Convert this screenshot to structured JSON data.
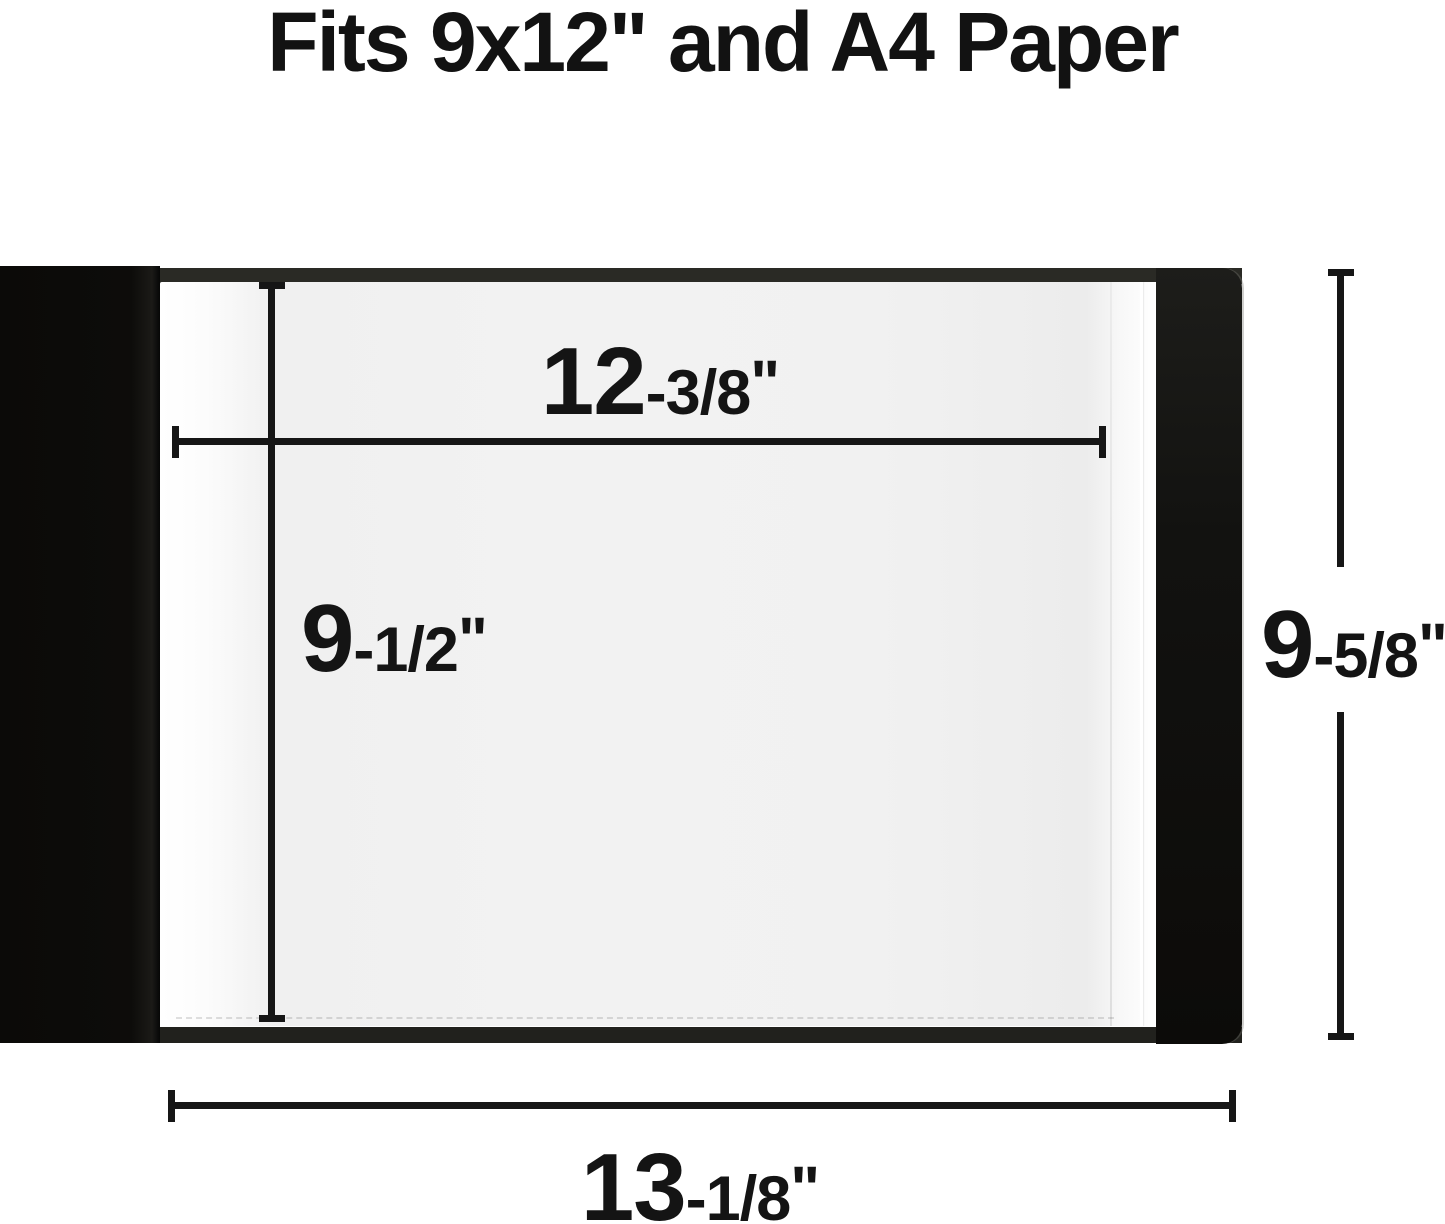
{
  "title": "Fits 9x12\" and A4 Paper",
  "colors": {
    "ink": "#161616",
    "cover_black": "#0d0c0a",
    "binder_edge_dark": "#2a2a25",
    "page_gray": "#f2f2f2",
    "background": "#ffffff"
  },
  "dimensions": {
    "inner_width": {
      "big": "12",
      "small": "-3/8",
      "unit": "\""
    },
    "inner_height": {
      "big": "9",
      "small": "-1/2",
      "unit": "\""
    },
    "outer_height": {
      "big": "9",
      "small": "-5/8",
      "unit": "\""
    },
    "outer_width": {
      "big": "13",
      "small": "-1/8",
      "unit": "\""
    }
  }
}
